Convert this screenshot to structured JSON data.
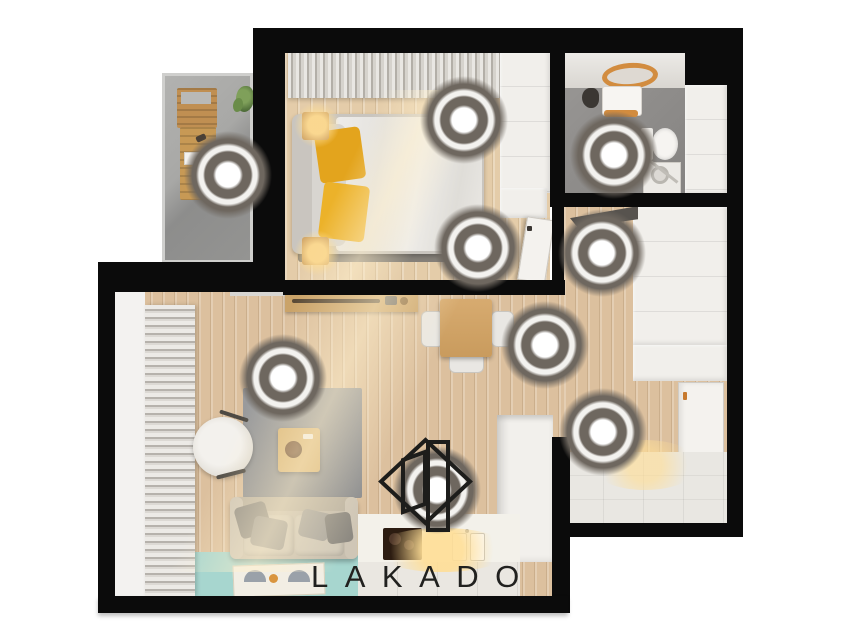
{
  "brand": {
    "logo_text": "LAKADO",
    "logo_icon": "open-door-in-diamond"
  },
  "scene": {
    "type": "apartment-floorplan-top-view",
    "hotspot_count": 9,
    "hotspots": [
      {
        "room": "balcony",
        "x": 228,
        "y": 175
      },
      {
        "room": "bedroom-window",
        "x": 464,
        "y": 120
      },
      {
        "room": "bedroom-door",
        "x": 478,
        "y": 248
      },
      {
        "room": "bathroom",
        "x": 614,
        "y": 155
      },
      {
        "room": "hallway-wardrobe",
        "x": 602,
        "y": 253
      },
      {
        "room": "dining",
        "x": 545,
        "y": 345
      },
      {
        "room": "living-room",
        "x": 283,
        "y": 378
      },
      {
        "room": "entrance",
        "x": 603,
        "y": 432
      },
      {
        "room": "kitchen",
        "x": 437,
        "y": 490
      }
    ]
  },
  "theme": {
    "wall": "#0b0b0b",
    "wood": "#dcc09e",
    "wood_light": "#e4cca9",
    "teal": "#a7d6cf",
    "balcony": "#a2a2a0",
    "tile_grey": "#8f8d8b",
    "furn": "#f1efeb",
    "accent": "#d28c3f",
    "hotspot": "#6e675f",
    "ink": "#21211f"
  }
}
